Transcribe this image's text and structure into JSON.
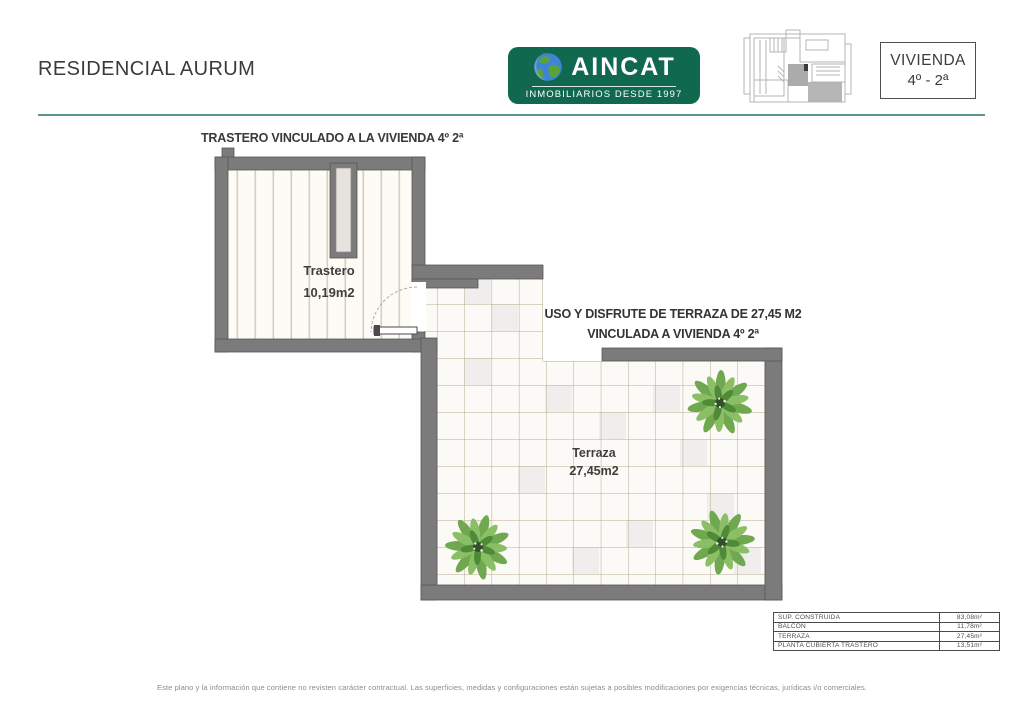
{
  "header": {
    "title": "RESIDENCIAL AURUM",
    "logo": {
      "name": "AINCAT",
      "tagline": "INMOBILIARIOS DESDE 1997",
      "bg_color": "#10694f"
    },
    "unit_badge": {
      "line1": "VIVIENDA",
      "line2": "4º - 2ª"
    }
  },
  "plan": {
    "trastero_caption": "TRASTERO VINCULADO A LA VIVIENDA 4º 2ª",
    "trastero_label": "Trastero",
    "trastero_area": "10,19m2",
    "terraza_label": "Terraza",
    "terraza_area": "27,45m2",
    "terraza_note_line1": "USO Y DISFRUTE DE TERRAZA DE 27,45 M2",
    "terraza_note_line2": "VINCULADA A VIVIENDA 4º 2ª"
  },
  "surface_table": {
    "rows": [
      {
        "label": "SUP. CONSTRUIDA",
        "value": "83,08m²"
      },
      {
        "label": "BALCÓN",
        "value": "11,78m²"
      },
      {
        "label": "TERRAZA",
        "value": "27,45m²"
      },
      {
        "label": "PLANTA CUBIERTA TRASTERO",
        "value": "13,51m²"
      }
    ]
  },
  "footer": {
    "disclaimer": "Este plano y la información que contiene no revisten carácter contractual. Las superficies, medidas y configuraciones están sujetas a posibles modificaciones por exigencias técnicas, jurídicas i/o comerciales."
  },
  "colors": {
    "accent_green": "#10694f",
    "divider_teal": "#5b948c",
    "wall_gray": "#7b7b7b",
    "tile_line": "#b9a98c",
    "floor_stripe": "#d8cebe"
  }
}
